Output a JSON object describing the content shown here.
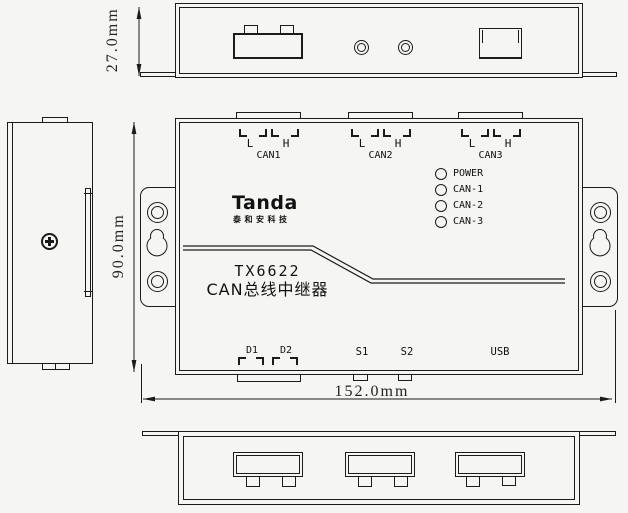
{
  "colors": {
    "background": "#f5f5f3",
    "line": "#1b1b1b"
  },
  "dimensions": {
    "top_height": "27.0mm",
    "front_height": "90.0mm",
    "front_width": "152.0mm"
  },
  "front_view": {
    "connectors": [
      {
        "label": "CAN1",
        "pin_low": "L",
        "pin_high": "H"
      },
      {
        "label": "CAN2",
        "pin_low": "L",
        "pin_high": "H"
      },
      {
        "label": "CAN3",
        "pin_low": "L",
        "pin_high": "H"
      }
    ],
    "leds": [
      {
        "label": "POWER"
      },
      {
        "label": "CAN-1"
      },
      {
        "label": "CAN-2"
      },
      {
        "label": "CAN-3"
      }
    ],
    "logo": {
      "brand": "Tanda",
      "tagline": "泰和安科技"
    },
    "model": "TX6622",
    "product_name": "CAN总线中继器",
    "ports": {
      "d1": "D1",
      "d2": "D2",
      "s1": "S1",
      "s2": "S2",
      "usb": "USB"
    }
  }
}
